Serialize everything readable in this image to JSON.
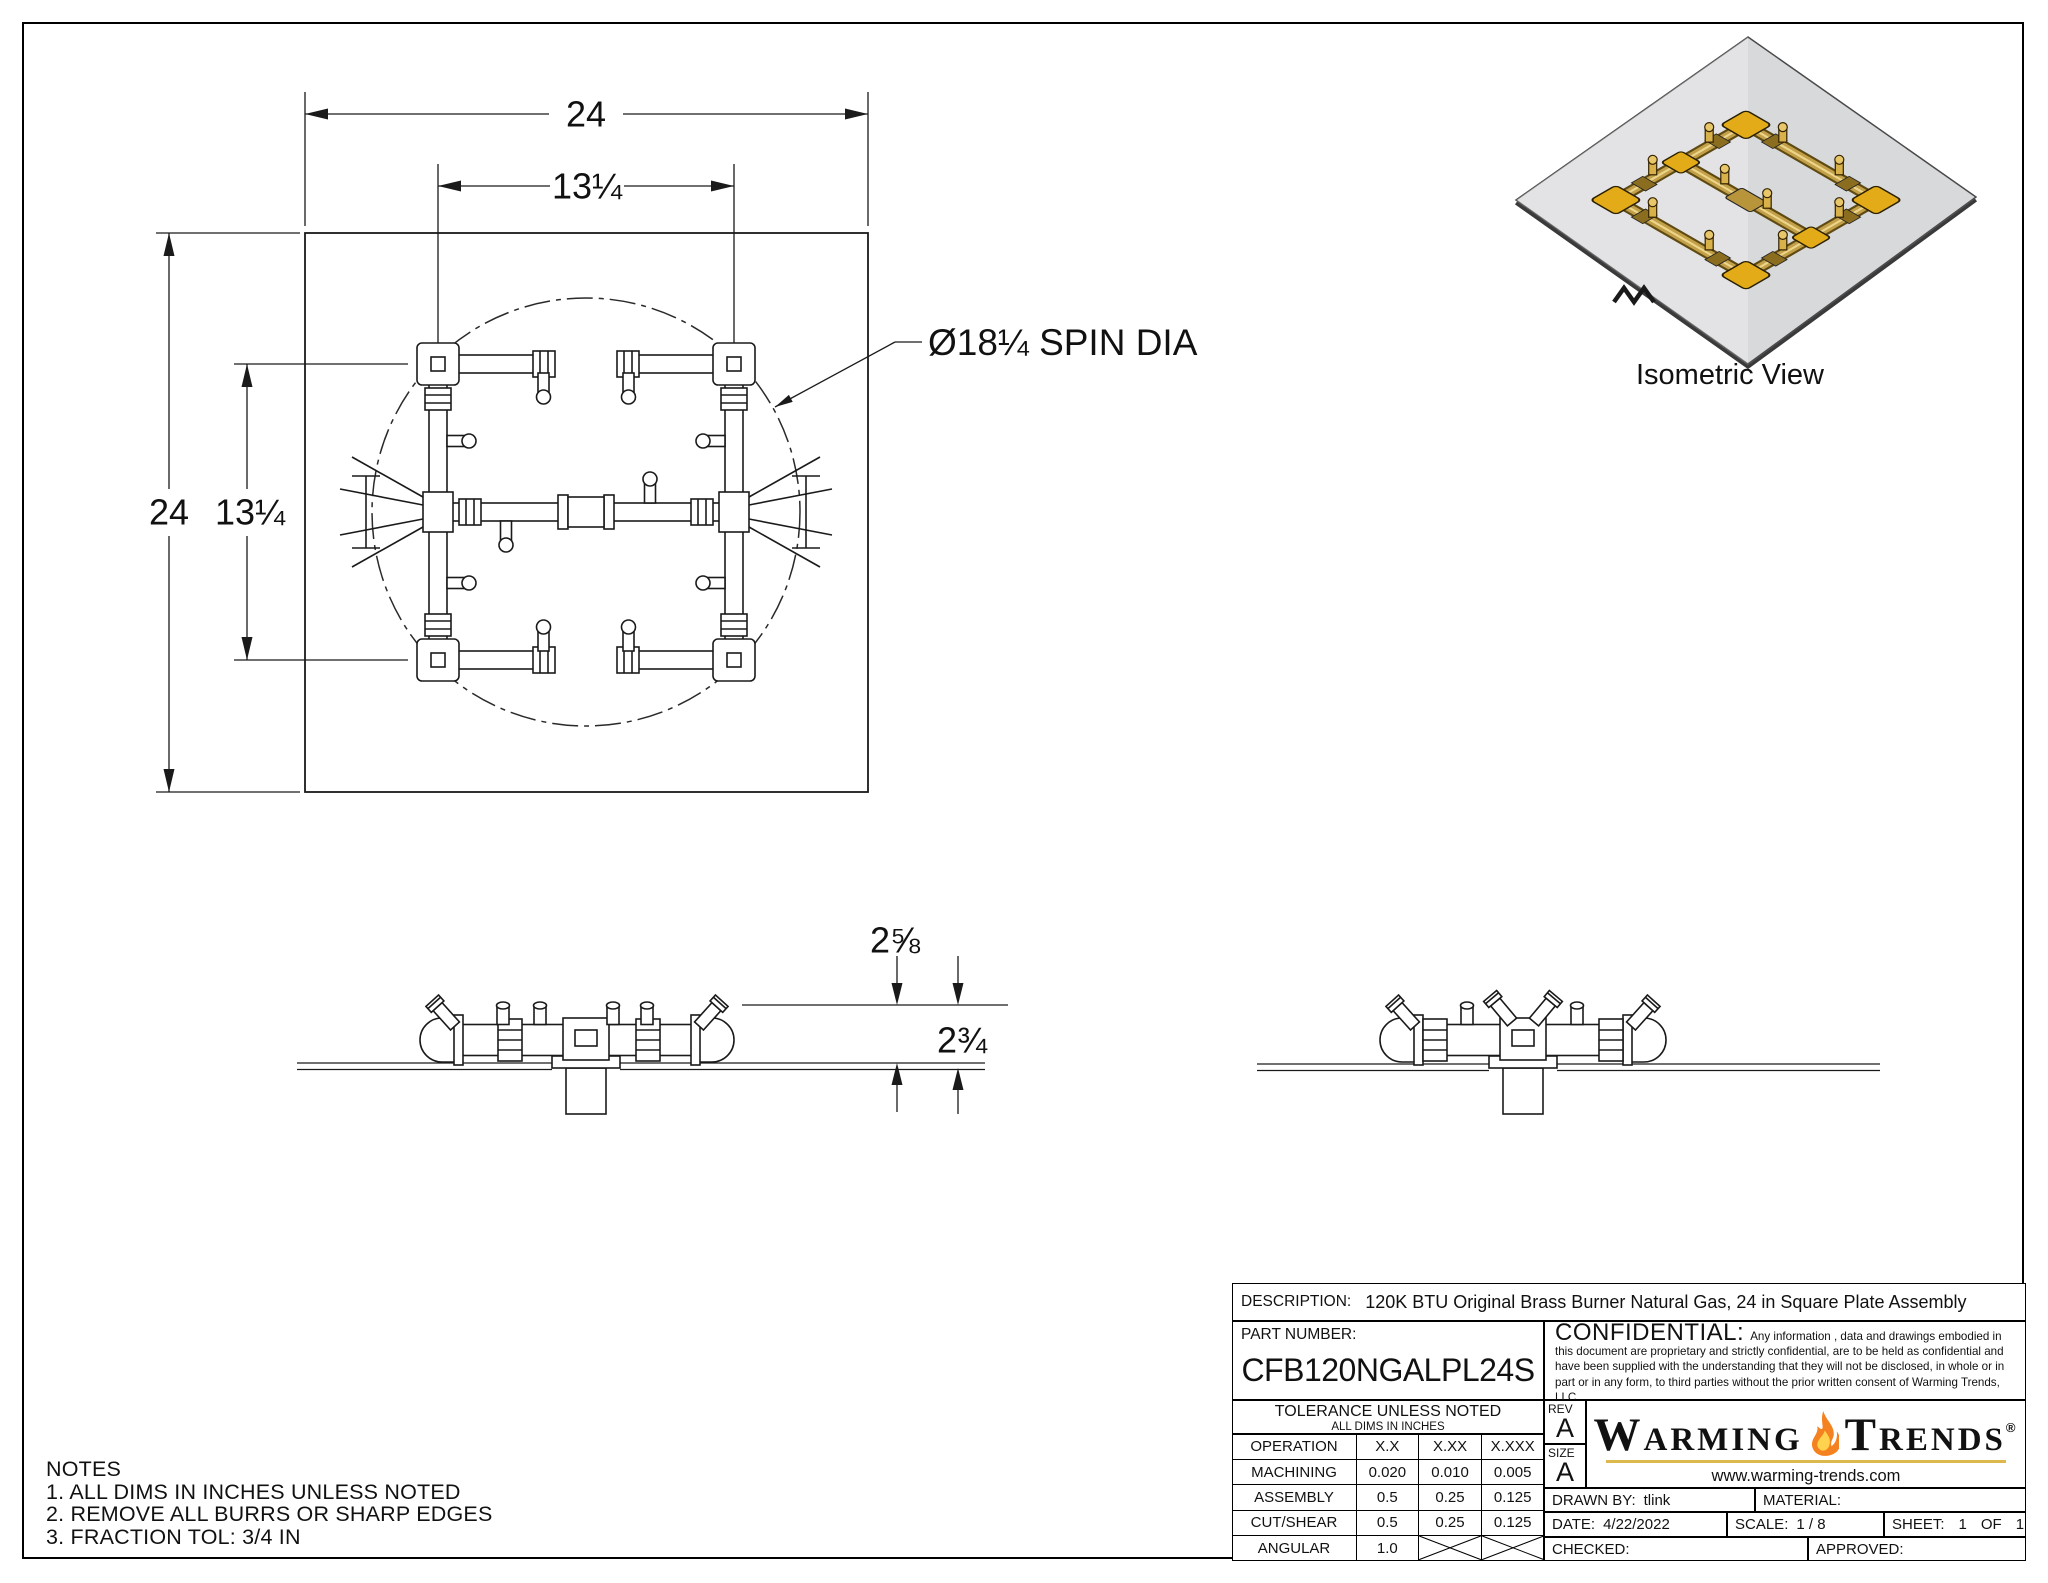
{
  "drawing": {
    "plan": {
      "dim_outer_w": "24",
      "dim_inner_w": "13¼",
      "dim_outer_h": "24",
      "dim_inner_h": "13¼",
      "spin_label": "Ø18¼ SPIN DIA"
    },
    "front": {
      "dim_above_plate": "2⅝",
      "dim_below_plate": "2¾"
    },
    "iso": {
      "caption": "Isometric View"
    },
    "notes": {
      "title": "NOTES",
      "items": [
        "1. ALL DIMS IN INCHES UNLESS NOTED",
        "2. REMOVE ALL BURRS OR SHARP EDGES",
        "3. FRACTION TOL: 3/4 IN"
      ]
    }
  },
  "title_block": {
    "description_label": "DESCRIPTION:",
    "description": "120K BTU Original Brass Burner Natural Gas, 24 in Square Plate Assembly",
    "part_number_label": "PART NUMBER:",
    "part_number": "CFB120NGALPL24S",
    "confidential_label": "CONFIDENTIAL:",
    "confidential_text": "Any information , data and drawings embodied in this document are proprietary and strictly confidential, are to be held as confidential and have been supplied with the understanding that they will not be disclosed, in whole or in part or in any form, to third parties without the prior written consent of Warming Trends, LLC.",
    "tolerance": {
      "title": "TOLERANCE UNLESS NOTED",
      "subtitle": "ALL DIMS IN INCHES",
      "headers": [
        "OPERATION",
        "X.X",
        "X.XX",
        "X.XXX"
      ],
      "rows": [
        {
          "label": "MACHINING",
          "values": [
            "0.020",
            "0.010",
            "0.005"
          ]
        },
        {
          "label": "ASSEMBLY",
          "values": [
            "0.5",
            "0.25",
            "0.125"
          ]
        },
        {
          "label": "CUT/SHEAR",
          "values": [
            "0.5",
            "0.25",
            "0.125"
          ]
        },
        {
          "label": "ANGULAR",
          "values": [
            "1.0",
            "",
            ""
          ]
        }
      ]
    },
    "rev_label": "REV",
    "rev": "A",
    "size_label": "SIZE",
    "size": "A",
    "brand": {
      "word_left_initial": "W",
      "word_left_rest": "ARMING",
      "word_right_initial": "T",
      "word_right_rest": "RENDS",
      "reg": "®",
      "website": "www.warming-trends.com"
    },
    "drawn_by_label": "DRAWN BY:",
    "drawn_by": "tlink",
    "material_label": "MATERIAL:",
    "date_label": "DATE:",
    "date": "4/22/2022",
    "scale_label": "SCALE:",
    "scale": "1 / 8",
    "sheet_label": "SHEET:",
    "sheet_no": "1",
    "of_label": "OF",
    "sheet_total": "1",
    "checked_label": "CHECKED:",
    "approved_label": "APPROVED:"
  }
}
